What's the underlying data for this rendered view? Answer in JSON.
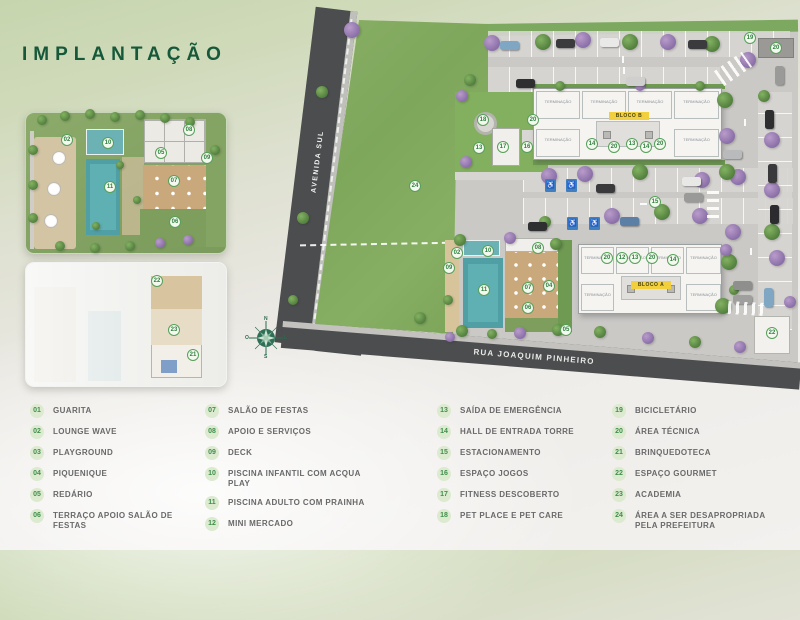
{
  "header": {
    "title": "IMPLANTAÇÃO"
  },
  "compass": {
    "n": "N",
    "s": "S",
    "w": "O",
    "e": "L"
  },
  "plan": {
    "streets": [
      {
        "name": "AVENIDA SUL"
      },
      {
        "name": "RUA JOAQUIM PINHEIRO"
      }
    ],
    "blocks": [
      {
        "label": "BLOCO B"
      },
      {
        "label": "BLOCO A"
      }
    ],
    "unit_label": "TERMINAÇÃO"
  },
  "colors": {
    "accent_green": "#3f8f4b",
    "title_green": "#15593a",
    "road_gray": "#4b4d4f",
    "grass_green": "#84ab61",
    "pool_teal": "#55a3a8",
    "block_badge_yellow": "#f2cf3c"
  },
  "scene": {
    "markers": [
      {
        "n": "24",
        "x": 415,
        "y": 186
      },
      {
        "n": "18",
        "x": 483,
        "y": 120
      },
      {
        "n": "20",
        "x": 533,
        "y": 120
      },
      {
        "n": "13",
        "x": 479,
        "y": 148
      },
      {
        "n": "17",
        "x": 503,
        "y": 147
      },
      {
        "n": "16",
        "x": 527,
        "y": 147
      },
      {
        "n": "15",
        "x": 655,
        "y": 202
      },
      {
        "n": "19",
        "x": 750,
        "y": 38
      },
      {
        "n": "20",
        "x": 776,
        "y": 48
      },
      {
        "n": "22",
        "x": 772,
        "y": 333
      },
      {
        "n": "02",
        "x": 457,
        "y": 253
      },
      {
        "n": "10",
        "x": 488,
        "y": 251
      },
      {
        "n": "08",
        "x": 538,
        "y": 248
      },
      {
        "n": "09",
        "x": 449,
        "y": 268
      },
      {
        "n": "11",
        "x": 484,
        "y": 290
      },
      {
        "n": "07",
        "x": 528,
        "y": 288
      },
      {
        "n": "04",
        "x": 549,
        "y": 286
      },
      {
        "n": "06",
        "x": 528,
        "y": 308
      },
      {
        "n": "05",
        "x": 566,
        "y": 330
      },
      {
        "n": "14",
        "x": 592,
        "y": 144
      },
      {
        "n": "20",
        "x": 614,
        "y": 147
      },
      {
        "n": "13",
        "x": 632,
        "y": 144
      },
      {
        "n": "14",
        "x": 646,
        "y": 147
      },
      {
        "n": "20",
        "x": 660,
        "y": 144
      },
      {
        "n": "20",
        "x": 607,
        "y": 258
      },
      {
        "n": "12",
        "x": 622,
        "y": 258
      },
      {
        "n": "13",
        "x": 635,
        "y": 258
      },
      {
        "n": "20",
        "x": 652,
        "y": 258
      },
      {
        "n": "14",
        "x": 673,
        "y": 260
      },
      {
        "n": "02",
        "x": 67,
        "y": 140
      },
      {
        "n": "10",
        "x": 108,
        "y": 143
      },
      {
        "n": "08",
        "x": 189,
        "y": 130
      },
      {
        "n": "05",
        "x": 161,
        "y": 153
      },
      {
        "n": "09",
        "x": 207,
        "y": 158
      },
      {
        "n": "07",
        "x": 174,
        "y": 181
      },
      {
        "n": "11",
        "x": 110,
        "y": 187
      },
      {
        "n": "06",
        "x": 175,
        "y": 222
      },
      {
        "n": "22",
        "x": 157,
        "y": 281
      },
      {
        "n": "23",
        "x": 174,
        "y": 330
      },
      {
        "n": "21",
        "x": 193,
        "y": 355
      }
    ],
    "trees": [
      {
        "x": 352,
        "y": 30,
        "c": "p"
      },
      {
        "x": 492,
        "y": 43,
        "c": "p"
      },
      {
        "x": 543,
        "y": 42,
        "c": "g"
      },
      {
        "x": 583,
        "y": 40,
        "c": "p"
      },
      {
        "x": 630,
        "y": 42,
        "c": "g"
      },
      {
        "x": 668,
        "y": 42,
        "c": "p"
      },
      {
        "x": 712,
        "y": 44,
        "c": "g"
      },
      {
        "x": 748,
        "y": 60,
        "c": "p"
      },
      {
        "x": 470,
        "y": 80,
        "c": "g",
        "r": 6
      },
      {
        "x": 560,
        "y": 86,
        "c": "g",
        "r": 5
      },
      {
        "x": 640,
        "y": 86,
        "c": "p",
        "r": 5
      },
      {
        "x": 700,
        "y": 86,
        "c": "g",
        "r": 5
      },
      {
        "x": 549,
        "y": 176,
        "c": "p"
      },
      {
        "x": 585,
        "y": 174,
        "c": "p"
      },
      {
        "x": 640,
        "y": 172,
        "c": "g"
      },
      {
        "x": 702,
        "y": 180,
        "c": "p"
      },
      {
        "x": 738,
        "y": 177,
        "c": "p"
      },
      {
        "x": 612,
        "y": 216,
        "c": "p"
      },
      {
        "x": 662,
        "y": 212,
        "c": "g"
      },
      {
        "x": 700,
        "y": 216,
        "c": "p"
      },
      {
        "x": 545,
        "y": 222,
        "c": "g",
        "r": 6
      },
      {
        "x": 725,
        "y": 100,
        "c": "g"
      },
      {
        "x": 727,
        "y": 136,
        "c": "p"
      },
      {
        "x": 727,
        "y": 172,
        "c": "g"
      },
      {
        "x": 733,
        "y": 232,
        "c": "p"
      },
      {
        "x": 729,
        "y": 262,
        "c": "g"
      },
      {
        "x": 723,
        "y": 306,
        "c": "g"
      },
      {
        "x": 764,
        "y": 96,
        "c": "g",
        "r": 6
      },
      {
        "x": 772,
        "y": 140,
        "c": "p"
      },
      {
        "x": 772,
        "y": 190,
        "c": "p"
      },
      {
        "x": 772,
        "y": 232,
        "c": "g"
      },
      {
        "x": 777,
        "y": 258,
        "c": "p"
      },
      {
        "x": 790,
        "y": 302,
        "c": "p",
        "r": 6
      },
      {
        "x": 322,
        "y": 92,
        "c": "g",
        "r": 6
      },
      {
        "x": 303,
        "y": 218,
        "c": "g",
        "r": 6
      },
      {
        "x": 293,
        "y": 300,
        "c": "g",
        "r": 5
      },
      {
        "x": 462,
        "y": 96,
        "c": "p",
        "r": 6
      },
      {
        "x": 466,
        "y": 162,
        "c": "p",
        "r": 6
      },
      {
        "x": 460,
        "y": 240,
        "c": "g",
        "r": 6
      },
      {
        "x": 510,
        "y": 238,
        "c": "p",
        "r": 6
      },
      {
        "x": 556,
        "y": 244,
        "c": "g",
        "r": 6
      },
      {
        "x": 448,
        "y": 300,
        "c": "g",
        "r": 5
      },
      {
        "x": 462,
        "y": 331,
        "c": "g",
        "r": 6
      },
      {
        "x": 520,
        "y": 333,
        "c": "p",
        "r": 6
      },
      {
        "x": 558,
        "y": 330,
        "c": "g",
        "r": 6
      },
      {
        "x": 420,
        "y": 318,
        "c": "g",
        "r": 6
      },
      {
        "x": 450,
        "y": 337,
        "c": "p",
        "r": 5
      },
      {
        "x": 492,
        "y": 334,
        "c": "g",
        "r": 5
      },
      {
        "x": 600,
        "y": 332,
        "c": "g",
        "r": 6
      },
      {
        "x": 648,
        "y": 338,
        "c": "p",
        "r": 6
      },
      {
        "x": 695,
        "y": 342,
        "c": "g",
        "r": 6
      },
      {
        "x": 740,
        "y": 347,
        "c": "p",
        "r": 6
      },
      {
        "x": 726,
        "y": 250,
        "c": "p",
        "r": 6
      },
      {
        "x": 734,
        "y": 290,
        "c": "g",
        "r": 5
      },
      {
        "x": 42,
        "y": 120,
        "c": "g",
        "r": 5
      },
      {
        "x": 65,
        "y": 116,
        "c": "g",
        "r": 5
      },
      {
        "x": 90,
        "y": 114,
        "c": "g",
        "r": 5
      },
      {
        "x": 115,
        "y": 117,
        "c": "g",
        "r": 5
      },
      {
        "x": 140,
        "y": 115,
        "c": "g",
        "r": 5
      },
      {
        "x": 165,
        "y": 118,
        "c": "g",
        "r": 5
      },
      {
        "x": 190,
        "y": 122,
        "c": "g",
        "r": 5
      },
      {
        "x": 33,
        "y": 150,
        "c": "g",
        "r": 5
      },
      {
        "x": 33,
        "y": 185,
        "c": "g",
        "r": 5
      },
      {
        "x": 33,
        "y": 218,
        "c": "g",
        "r": 5
      },
      {
        "x": 60,
        "y": 246,
        "c": "g",
        "r": 5
      },
      {
        "x": 95,
        "y": 248,
        "c": "g",
        "r": 5
      },
      {
        "x": 130,
        "y": 246,
        "c": "g",
        "r": 5
      },
      {
        "x": 160,
        "y": 243,
        "c": "p",
        "r": 5
      },
      {
        "x": 188,
        "y": 240,
        "c": "p",
        "r": 5
      },
      {
        "x": 215,
        "y": 150,
        "c": "g",
        "r": 5
      },
      {
        "x": 120,
        "y": 165,
        "c": "g",
        "r": 4
      },
      {
        "x": 137,
        "y": 200,
        "c": "g",
        "r": 4
      },
      {
        "x": 96,
        "y": 226,
        "c": "g",
        "r": 4
      }
    ],
    "cars": [
      {
        "x": 500,
        "y": 41,
        "o": "h",
        "c": "#7fa7c4"
      },
      {
        "x": 556,
        "y": 39,
        "o": "h",
        "c": "#3b3b3d"
      },
      {
        "x": 600,
        "y": 38,
        "o": "h",
        "c": "#e9e9e7"
      },
      {
        "x": 688,
        "y": 40,
        "o": "h",
        "c": "#3b3b3d"
      },
      {
        "x": 516,
        "y": 79,
        "o": "h",
        "c": "#2f2f31"
      },
      {
        "x": 626,
        "y": 77,
        "o": "h",
        "c": "#cfcfcd"
      },
      {
        "x": 596,
        "y": 184,
        "o": "h",
        "c": "#3a3a3c"
      },
      {
        "x": 682,
        "y": 177,
        "o": "h",
        "c": "#e8e8e6"
      },
      {
        "x": 684,
        "y": 193,
        "o": "h",
        "c": "#9a9a98"
      },
      {
        "x": 620,
        "y": 217,
        "o": "h",
        "c": "#5b7fa5"
      },
      {
        "x": 528,
        "y": 222,
        "o": "h",
        "c": "#2f2f31"
      },
      {
        "x": 765,
        "y": 110,
        "o": "v",
        "c": "#2e2e30"
      },
      {
        "x": 768,
        "y": 164,
        "o": "v",
        "c": "#3a3a3c"
      },
      {
        "x": 770,
        "y": 205,
        "o": "v",
        "c": "#2c2c2e"
      },
      {
        "x": 764,
        "y": 288,
        "o": "v",
        "c": "#7fa7c4"
      },
      {
        "x": 775,
        "y": 66,
        "o": "v",
        "c": "#9a9a98"
      },
      {
        "x": 723,
        "y": 150,
        "o": "h",
        "c": "#b9babb"
      },
      {
        "x": 733,
        "y": 281,
        "o": "h",
        "c": "#8f8f8d"
      },
      {
        "x": 733,
        "y": 295,
        "o": "h",
        "c": "#9f9f9d"
      }
    ],
    "accessible": [
      {
        "x": 545,
        "y": 179
      },
      {
        "x": 566,
        "y": 179
      },
      {
        "x": 567,
        "y": 217
      },
      {
        "x": 589,
        "y": 217
      }
    ],
    "crosswalks": [
      {
        "x": 716,
        "y": 60,
        "w": 34,
        "h": 18,
        "rot": -35,
        "g": 90
      },
      {
        "x": 728,
        "y": 302,
        "w": 36,
        "h": 13,
        "rot": 3,
        "g": 90
      },
      {
        "x": 707,
        "y": 190,
        "w": 12,
        "h": 28,
        "rot": 0,
        "g": 0
      }
    ],
    "arrows": [
      {
        "x": 622,
        "y": 56,
        "o": "v"
      },
      {
        "x": 623,
        "y": 67,
        "o": "v"
      },
      {
        "x": 744,
        "y": 119,
        "o": "v"
      },
      {
        "x": 750,
        "y": 248,
        "o": "v"
      },
      {
        "x": 640,
        "y": 203,
        "o": "h"
      }
    ],
    "umbrellas": [
      {
        "x": 58,
        "y": 157
      },
      {
        "x": 53,
        "y": 188
      },
      {
        "x": 50,
        "y": 220
      }
    ]
  },
  "legend": {
    "columns": [
      [
        {
          "num": "01",
          "label": "GUARITA"
        },
        {
          "num": "02",
          "label": "LOUNGE WAVE"
        },
        {
          "num": "03",
          "label": "PLAYGROUND"
        },
        {
          "num": "04",
          "label": "PIQUENIQUE"
        },
        {
          "num": "05",
          "label": "REDÁRIO"
        },
        {
          "num": "06",
          "label": "TERRAÇO APOIO SALÃO DE FESTAS"
        }
      ],
      [
        {
          "num": "07",
          "label": "SALÃO DE FESTAS"
        },
        {
          "num": "08",
          "label": "APOIO E SERVIÇOS"
        },
        {
          "num": "09",
          "label": "DECK"
        },
        {
          "num": "10",
          "label": "PISCINA INFANTIL COM ACQUA PLAY"
        },
        {
          "num": "11",
          "label": "PISCINA ADULTO COM PRAINHA"
        },
        {
          "num": "12",
          "label": "MINI MERCADO"
        }
      ],
      [
        {
          "num": "13",
          "label": "SAÍDA DE EMERGÊNCIA"
        },
        {
          "num": "14",
          "label": "HALL DE ENTRADA TORRE"
        },
        {
          "num": "15",
          "label": "ESTACIONAMENTO"
        },
        {
          "num": "16",
          "label": "ESPAÇO JOGOS"
        },
        {
          "num": "17",
          "label": "FITNESS DESCOBERTO"
        },
        {
          "num": "18",
          "label": "PET PLACE E PET CARE"
        }
      ],
      [
        {
          "num": "19",
          "label": "BICICLETÁRIO"
        },
        {
          "num": "20",
          "label": "ÁREA TÉCNICA"
        },
        {
          "num": "21",
          "label": "BRINQUEDOTECA"
        },
        {
          "num": "22",
          "label": "ESPAÇO GOURMET"
        },
        {
          "num": "23",
          "label": "ACADEMIA"
        },
        {
          "num": "24",
          "label": "ÁREA A SER DESAPROPRIADA PELA PREFEITURA"
        }
      ]
    ]
  }
}
